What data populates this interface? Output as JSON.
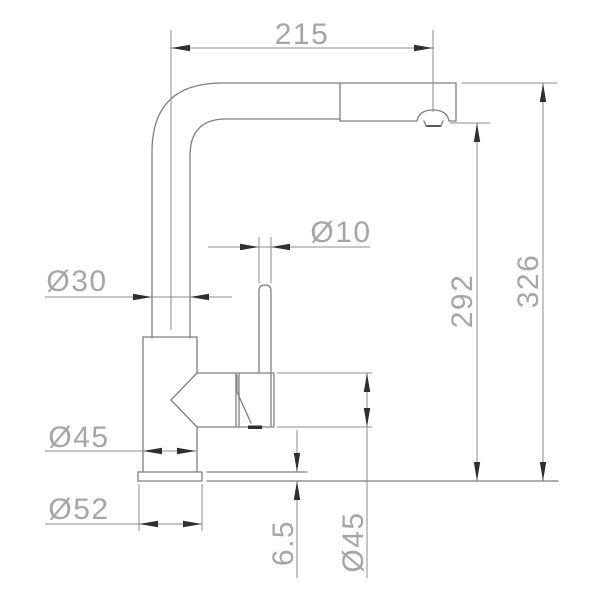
{
  "drawing": {
    "title": "Kitchen faucet dimensional drawing (side view)",
    "dimensions": {
      "spout_reach": "215",
      "overall_height": "326",
      "spout_outlet_height": "292",
      "riser_diameter": "Ø30",
      "handle_rod_diameter": "Ø10",
      "body_diameter": "Ø45",
      "base_flange_diameter": "Ø52",
      "base_flange_thickness": "6.5",
      "handle_housing_diameter": "Ø45"
    },
    "colors": {
      "background": "#ffffff",
      "outline_line": "#7f7f7f",
      "dimension_line": "#8c8c8c",
      "arrowhead": "#2f2f2f",
      "label_text": "#a6a6a6"
    }
  }
}
